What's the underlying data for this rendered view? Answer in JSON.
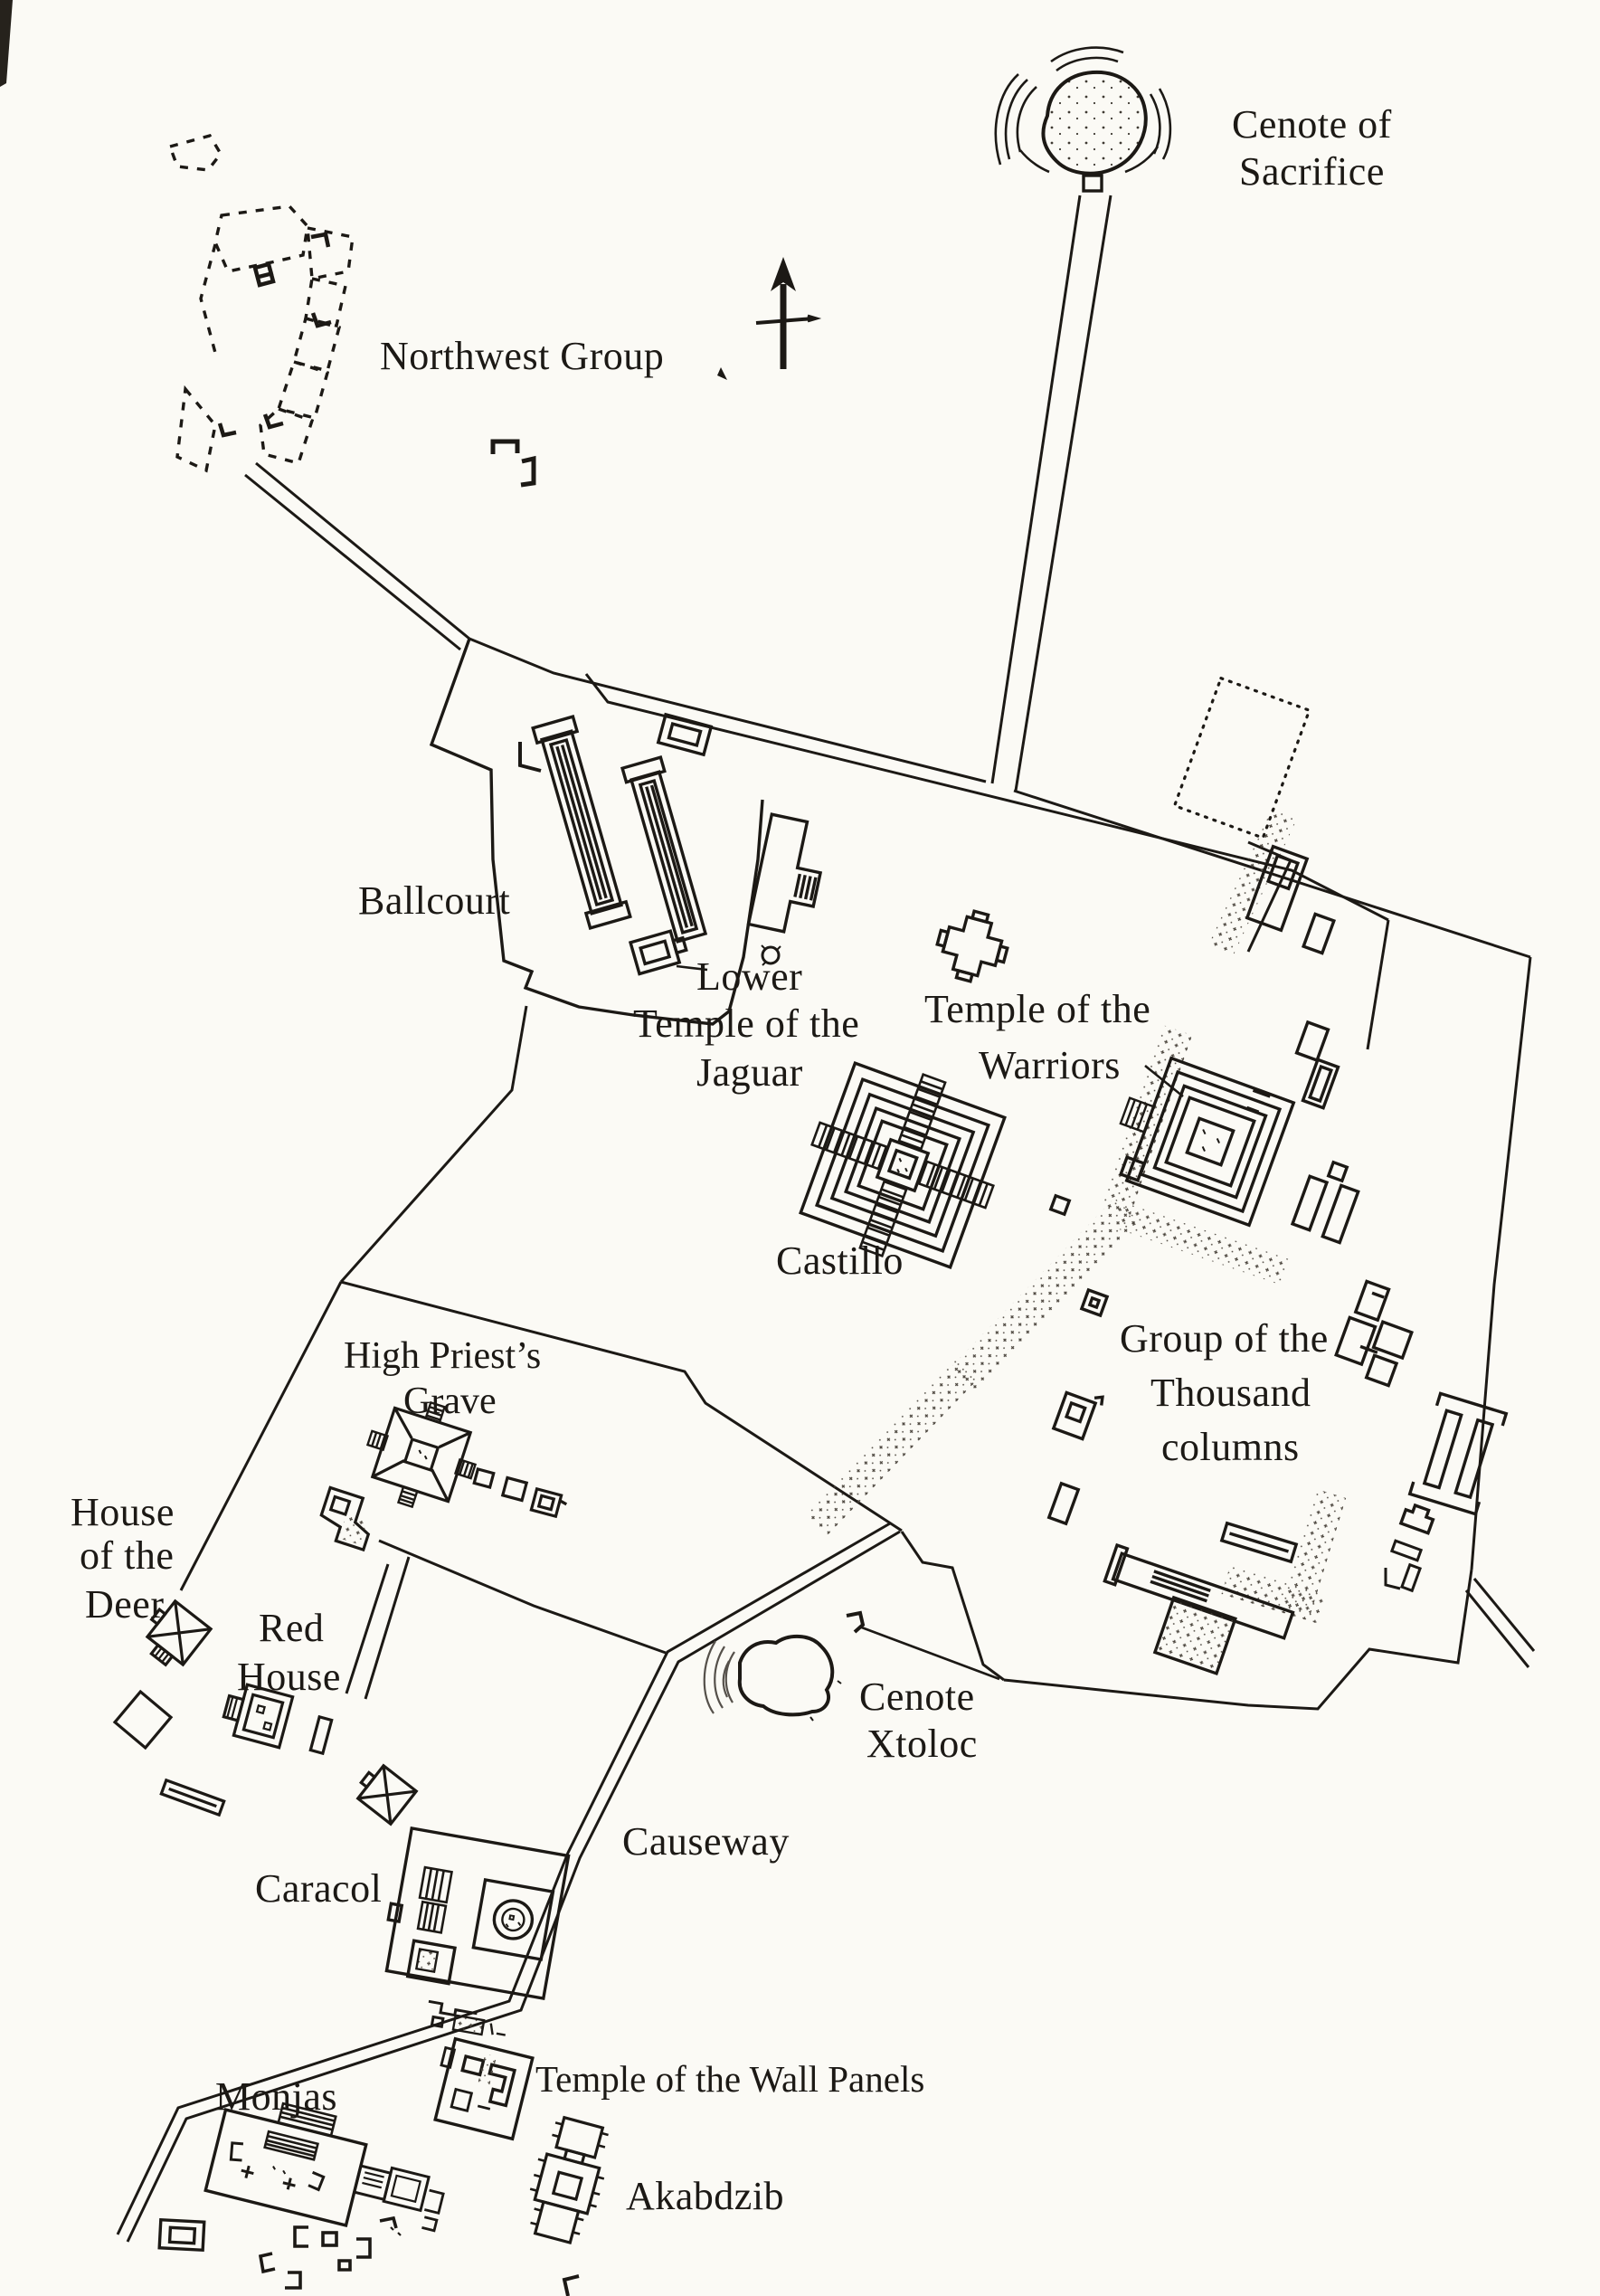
{
  "document": {
    "title": "Archaeological site map of Chichen Itza",
    "type": "scanned line-drawn site plan"
  },
  "colors": {
    "paper": "#fbfaf5",
    "ink": "#1c1915"
  },
  "map": {
    "compass": {
      "icon": "north-arrow",
      "points_to": "north"
    },
    "labels": {
      "cenote_of_sacrifice": {
        "line1": "Cenote of",
        "line2": "Sacrifice"
      },
      "northwest_group": {
        "line1": "Northwest Group"
      },
      "ballcourt": {
        "line1": "Ballcourt"
      },
      "lower_temple_of_the_jaguar": {
        "line1": "Lower",
        "line2": "Temple of the",
        "line3": "Jaguar"
      },
      "temple_of_the_warriors": {
        "line1": "Temple of the",
        "line2": "Warriors"
      },
      "castillo": {
        "line1": "Castillo"
      },
      "group_of_the_thousand_columns": {
        "line1": "Group of the",
        "line2": "Thousand",
        "line3": "columns"
      },
      "high_priests_grave": {
        "line1": "High Priest’s",
        "line2": "Grave"
      },
      "house_of_the_deer": {
        "line1": "House",
        "line2": "of the",
        "line3": "Deer"
      },
      "red_house": {
        "line1": "Red",
        "line2": "House"
      },
      "cenote_xtoloc": {
        "line1": "Cenote",
        "line2": "Xtoloc"
      },
      "causeway": {
        "line1": "Causeway"
      },
      "caracol": {
        "line1": "Caracol"
      },
      "temple_of_the_wall_panels": {
        "line1": "Temple of the Wall Panels"
      },
      "monjas": {
        "line1": "Monjas"
      },
      "akabdzib": {
        "line1": "Akabdzib"
      }
    }
  }
}
